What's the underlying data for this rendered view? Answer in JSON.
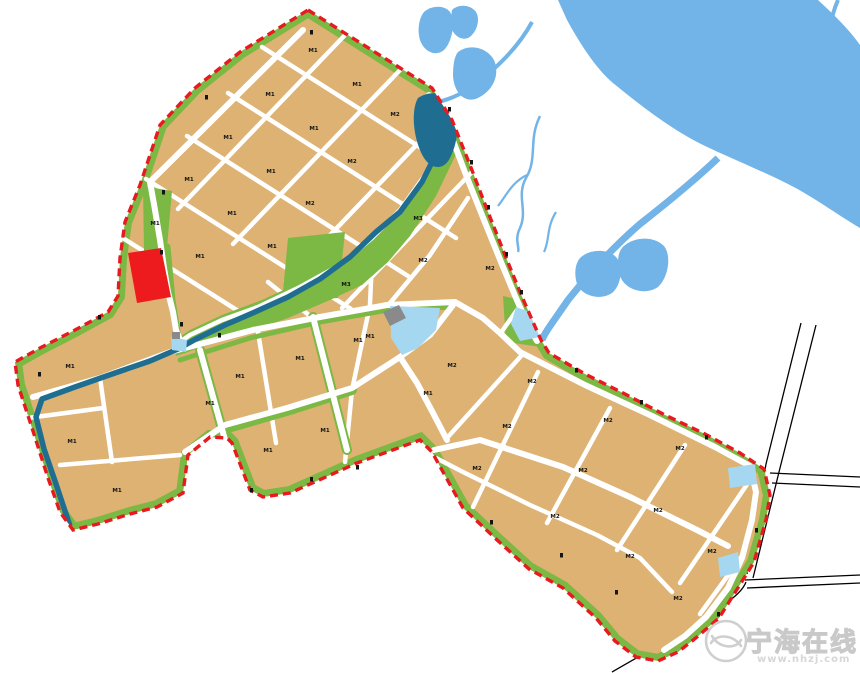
{
  "watermark": {
    "site_name": "宁海在线",
    "site_url": "www.nhzj.com",
    "logo": "swoosh-circle-logo"
  },
  "colors": {
    "parcel_tan": "#DDB272",
    "green_belt": "#7CB844",
    "river_teal": "#1F6E91",
    "water_blue": "#72B4E7",
    "pond_blue": "#A6D7F0",
    "boundary_red": "#E8191F",
    "special_parcel_red": "#EE1B1E",
    "road_white": "#FFFFFF",
    "structure_gray": "#8A8A8A",
    "label_dark": "#151515",
    "watermark_gray": "#CFCFCF"
  },
  "features": {
    "planning_boundary": "red dashed line",
    "green_belt": "green strip inside boundary",
    "river_corridor": "winding teal river with green banks",
    "outside_water": "sea / river / ponds outside plan area",
    "outside_roads": "black outline roads, bottom right",
    "special_parcel": "red parcel on west edge"
  },
  "parcels": [
    {
      "code": "M1",
      "x": 313,
      "y": 52
    },
    {
      "code": "M1",
      "x": 357,
      "y": 86
    },
    {
      "code": "M2",
      "x": 395,
      "y": 116
    },
    {
      "code": "M1",
      "x": 270,
      "y": 96
    },
    {
      "code": "M1",
      "x": 314,
      "y": 130
    },
    {
      "code": "M2",
      "x": 352,
      "y": 163
    },
    {
      "code": "M1",
      "x": 228,
      "y": 139
    },
    {
      "code": "M1",
      "x": 271,
      "y": 173
    },
    {
      "code": "M2",
      "x": 310,
      "y": 205
    },
    {
      "code": "M1",
      "x": 189,
      "y": 181
    },
    {
      "code": "M1",
      "x": 232,
      "y": 215
    },
    {
      "code": "M1",
      "x": 272,
      "y": 248
    },
    {
      "code": "M1",
      "x": 155,
      "y": 225
    },
    {
      "code": "M1",
      "x": 200,
      "y": 258
    },
    {
      "code": "M3",
      "x": 418,
      "y": 220
    },
    {
      "code": "M2",
      "x": 423,
      "y": 262
    },
    {
      "code": "M2",
      "x": 490,
      "y": 270
    },
    {
      "code": "M3",
      "x": 346,
      "y": 286
    },
    {
      "code": "M1",
      "x": 370,
      "y": 338
    },
    {
      "code": "M1",
      "x": 240,
      "y": 378
    },
    {
      "code": "M1",
      "x": 300,
      "y": 360
    },
    {
      "code": "M1",
      "x": 358,
      "y": 342
    },
    {
      "code": "M1",
      "x": 428,
      "y": 395
    },
    {
      "code": "M1",
      "x": 210,
      "y": 405
    },
    {
      "code": "M1",
      "x": 268,
      "y": 452
    },
    {
      "code": "M1",
      "x": 325,
      "y": 432
    },
    {
      "code": "M1",
      "x": 70,
      "y": 368
    },
    {
      "code": "M1",
      "x": 72,
      "y": 443
    },
    {
      "code": "M1",
      "x": 117,
      "y": 492
    },
    {
      "code": "M2",
      "x": 452,
      "y": 367
    },
    {
      "code": "M2",
      "x": 532,
      "y": 383
    },
    {
      "code": "M2",
      "x": 608,
      "y": 422
    },
    {
      "code": "M2",
      "x": 680,
      "y": 450
    },
    {
      "code": "M2",
      "x": 507,
      "y": 428
    },
    {
      "code": "M2",
      "x": 583,
      "y": 472
    },
    {
      "code": "M2",
      "x": 658,
      "y": 512
    },
    {
      "code": "M2",
      "x": 712,
      "y": 553
    },
    {
      "code": "M2",
      "x": 477,
      "y": 470
    },
    {
      "code": "M2",
      "x": 555,
      "y": 518
    },
    {
      "code": "M2",
      "x": 630,
      "y": 558
    },
    {
      "code": "M2",
      "x": 678,
      "y": 600
    }
  ],
  "road_marks": [
    [
      448,
      107
    ],
    [
      470,
      160
    ],
    [
      487,
      205
    ],
    [
      505,
      252
    ],
    [
      520,
      290
    ],
    [
      575,
      368
    ],
    [
      640,
      400
    ],
    [
      705,
      435
    ],
    [
      755,
      528
    ],
    [
      717,
      612
    ],
    [
      205,
      95
    ],
    [
      160,
      250
    ],
    [
      180,
      322
    ],
    [
      218,
      333
    ],
    [
      98,
      315
    ],
    [
      38,
      372
    ],
    [
      250,
      488
    ],
    [
      310,
      477
    ],
    [
      490,
      520
    ],
    [
      560,
      553
    ],
    [
      615,
      590
    ],
    [
      356,
      465
    ],
    [
      162,
      190
    ],
    [
      310,
      30
    ]
  ]
}
